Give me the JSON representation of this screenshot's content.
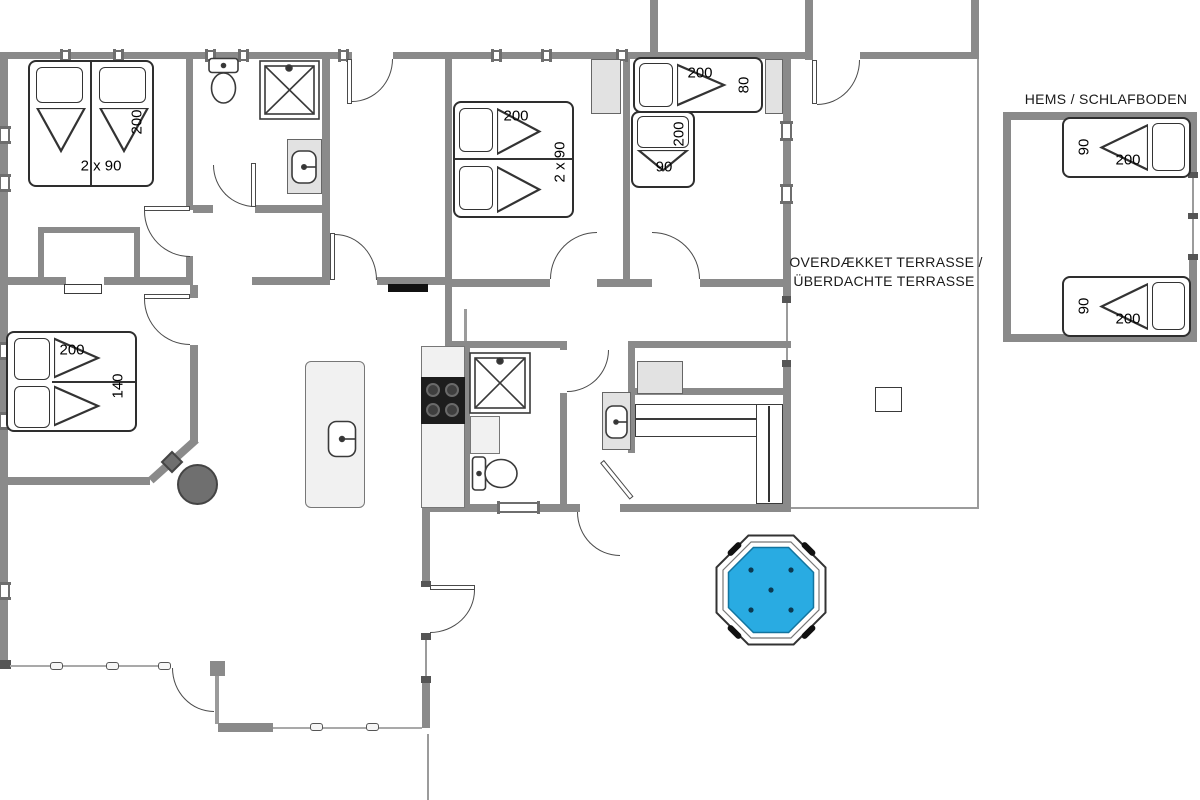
{
  "labels": {
    "hems_title": "HEMS / SCHLAFBODEN",
    "terrace_line1": "OVERDÆKKET TERRASSE /",
    "terrace_line2": "ÜBERDACHTE TERRASSE"
  },
  "dimensions": {
    "bedroom1_length": "200",
    "bedroom1_width": "2 x 90",
    "bedroom2_length": "200",
    "bedroom2_width": "2 x 90",
    "bedroom3_bed_a_length": "200",
    "bedroom3_bed_a_width": "80",
    "bedroom3_bed_b_length": "200",
    "bedroom3_bed_b_width": "90",
    "bedroom4_length": "200",
    "bedroom4_width": "140",
    "hems_bed_top_width": "90",
    "hems_bed_top_length": "200",
    "hems_bed_bottom_width": "90",
    "hems_bed_bottom_length": "200"
  },
  "colors": {
    "wall": "#8a8a8a",
    "hot_tub_water": "#29abe2",
    "stove_gray": "#6f6f6f"
  }
}
